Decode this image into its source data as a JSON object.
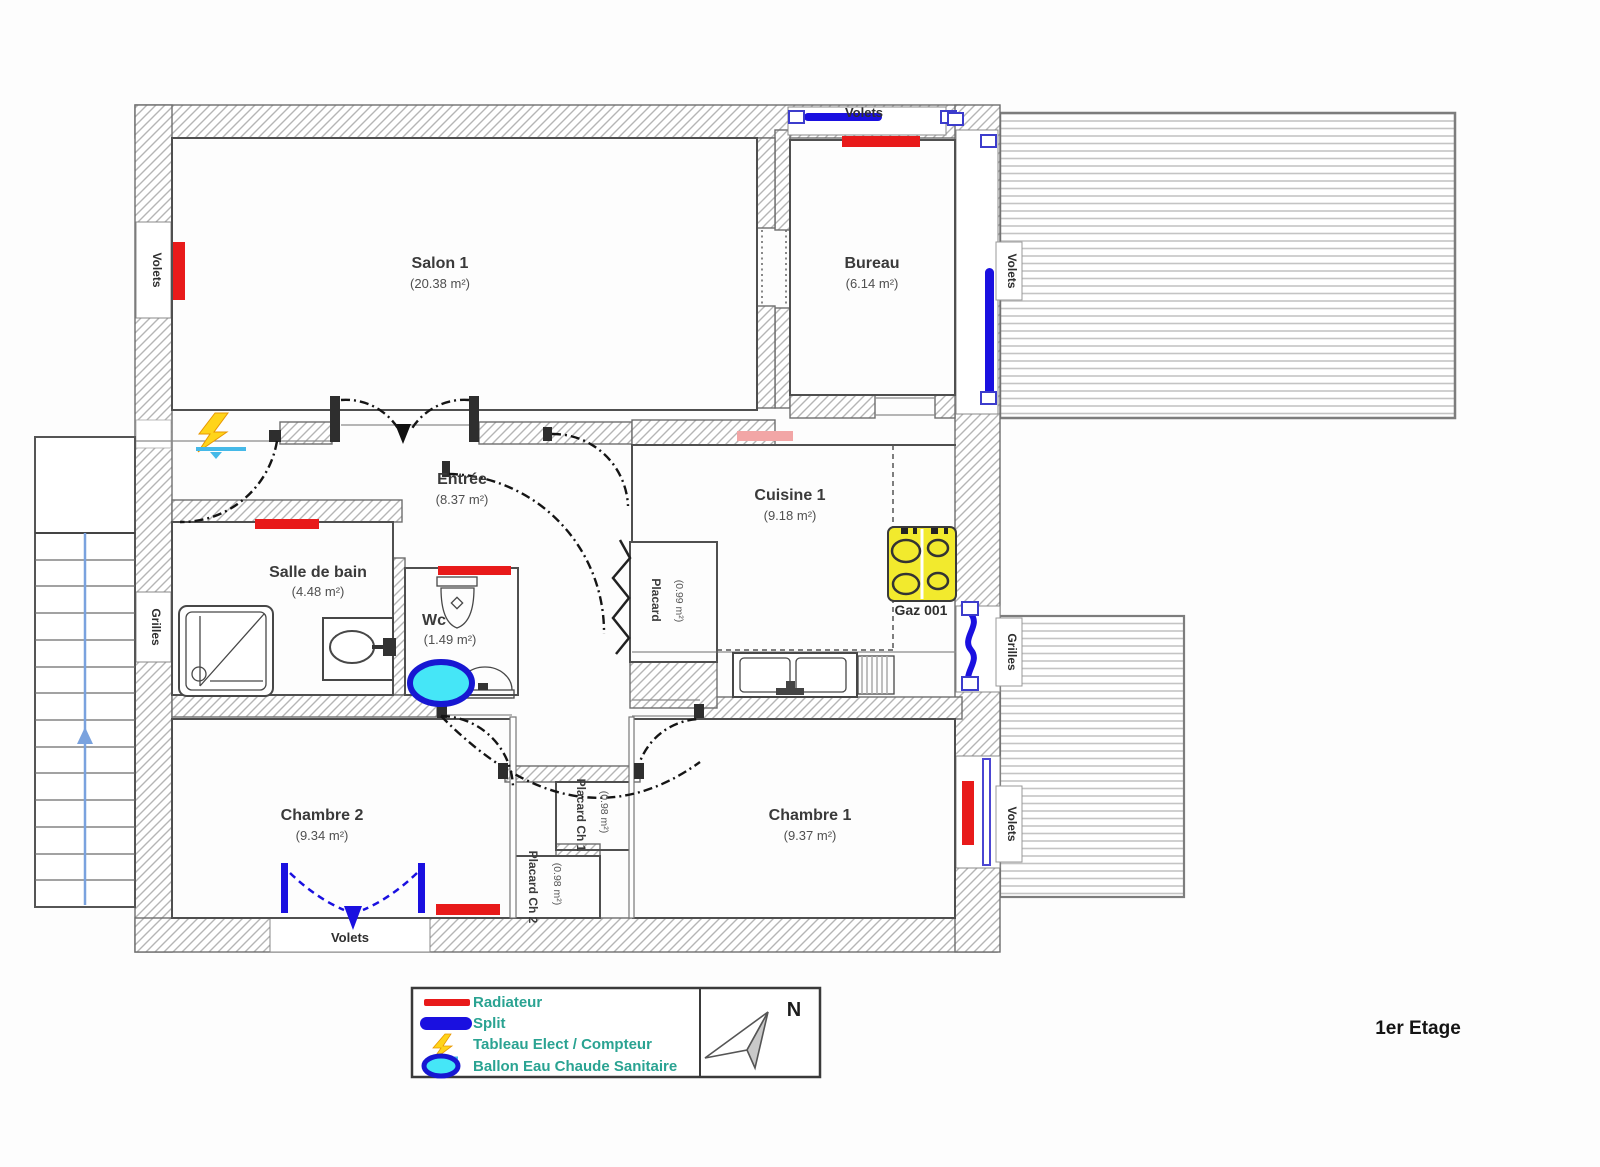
{
  "floor_title": "1er Etage",
  "rooms": {
    "salon": {
      "name": "Salon 1",
      "area": "(20.38 m²)"
    },
    "bureau": {
      "name": "Bureau",
      "area": "(6.14 m²)"
    },
    "entree": {
      "name": "Entrée",
      "area": "(8.37 m²)"
    },
    "cuisine": {
      "name": "Cuisine 1",
      "area": "(9.18 m²)"
    },
    "sdb": {
      "name": "Salle de bain",
      "area": "(4.48 m²)"
    },
    "wc": {
      "name": "Wc",
      "area": "(1.49 m²)"
    },
    "chambre2": {
      "name": "Chambre 2",
      "area": "(9.34 m²)"
    },
    "chambre1": {
      "name": "Chambre 1",
      "area": "(9.37 m²)"
    },
    "placard_entree": {
      "name": "Placard",
      "area": "(0.99 m²)"
    },
    "placard_ch1": {
      "name": "Placard Ch 1",
      "area": "(0.98 m²)"
    },
    "placard_ch2": {
      "name": "Placard Ch 2",
      "area": "(0.98 m²)"
    }
  },
  "labels": {
    "volets": "Volets",
    "grilles": "Grilles",
    "gaz": "Gaz 001",
    "north": "N"
  },
  "legend": {
    "items": [
      {
        "key": "radiateur",
        "label": "Radiateur"
      },
      {
        "key": "split",
        "label": "Split"
      },
      {
        "key": "tableau",
        "label": "Tableau Elect / Compteur"
      },
      {
        "key": "ballon",
        "label": "Ballon Eau Chaude Sanitaire"
      }
    ]
  },
  "colors": {
    "radiator": "#e81a1a",
    "radiator_light": "#f2a6a6",
    "split": "#1a10e0",
    "ballon_fill": "#45e6f7",
    "ballon_stroke": "#1717d2",
    "stove_fill": "#f2ea2d",
    "legend_text": "#2aa392",
    "stair_arrow": "#7aa2de",
    "tableau_yellow": "#ffd41a",
    "tableau_cyan": "#45b9e8"
  }
}
